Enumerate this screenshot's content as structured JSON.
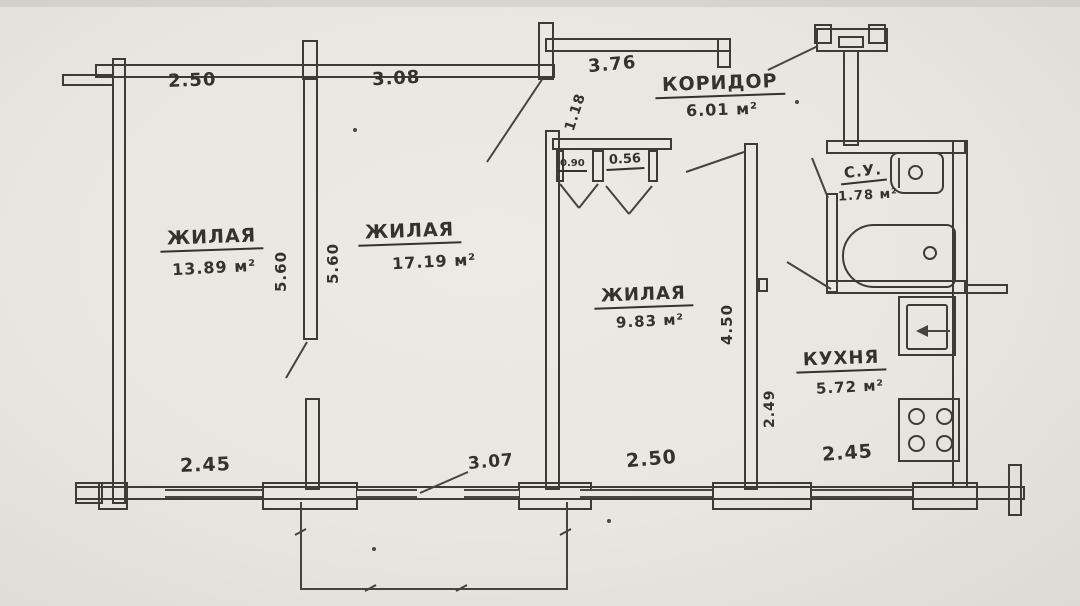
{
  "plan": {
    "title": "apartment-floor-plan",
    "rooms": [
      {
        "name": "ЖИЛАЯ",
        "area": "13.89 м²"
      },
      {
        "name": "ЖИЛАЯ",
        "area": "17.19 м²"
      },
      {
        "name": "ЖИЛАЯ",
        "area": "9.83 м²"
      },
      {
        "name": "КОРИДОР",
        "area": "6.01 м²"
      },
      {
        "name": "С.У.",
        "area": "1.78 м²"
      },
      {
        "name": "КУХНЯ",
        "area": "5.72 м²"
      }
    ],
    "dimensions_top": [
      "2.50",
      "3.08",
      "3.76"
    ],
    "dimensions_bottom": [
      "2.45",
      "3.07",
      "2.50",
      "2.45"
    ],
    "dimensions_vertical": {
      "room_depth_left": "5.60",
      "room_depth_right": "5.60",
      "room3_depth": "4.50",
      "kitchen_depth": "2.49",
      "entry_opening": "1.18"
    },
    "closet_dims": [
      "0.90",
      "0.56"
    ],
    "icons": [
      "bathtub-icon",
      "wash-basin-icon",
      "kitchen-sink-icon",
      "stove-icon",
      "vent-shaft"
    ],
    "colors": {
      "paper": "#e9e6df",
      "ink": "#3d3b35"
    }
  }
}
